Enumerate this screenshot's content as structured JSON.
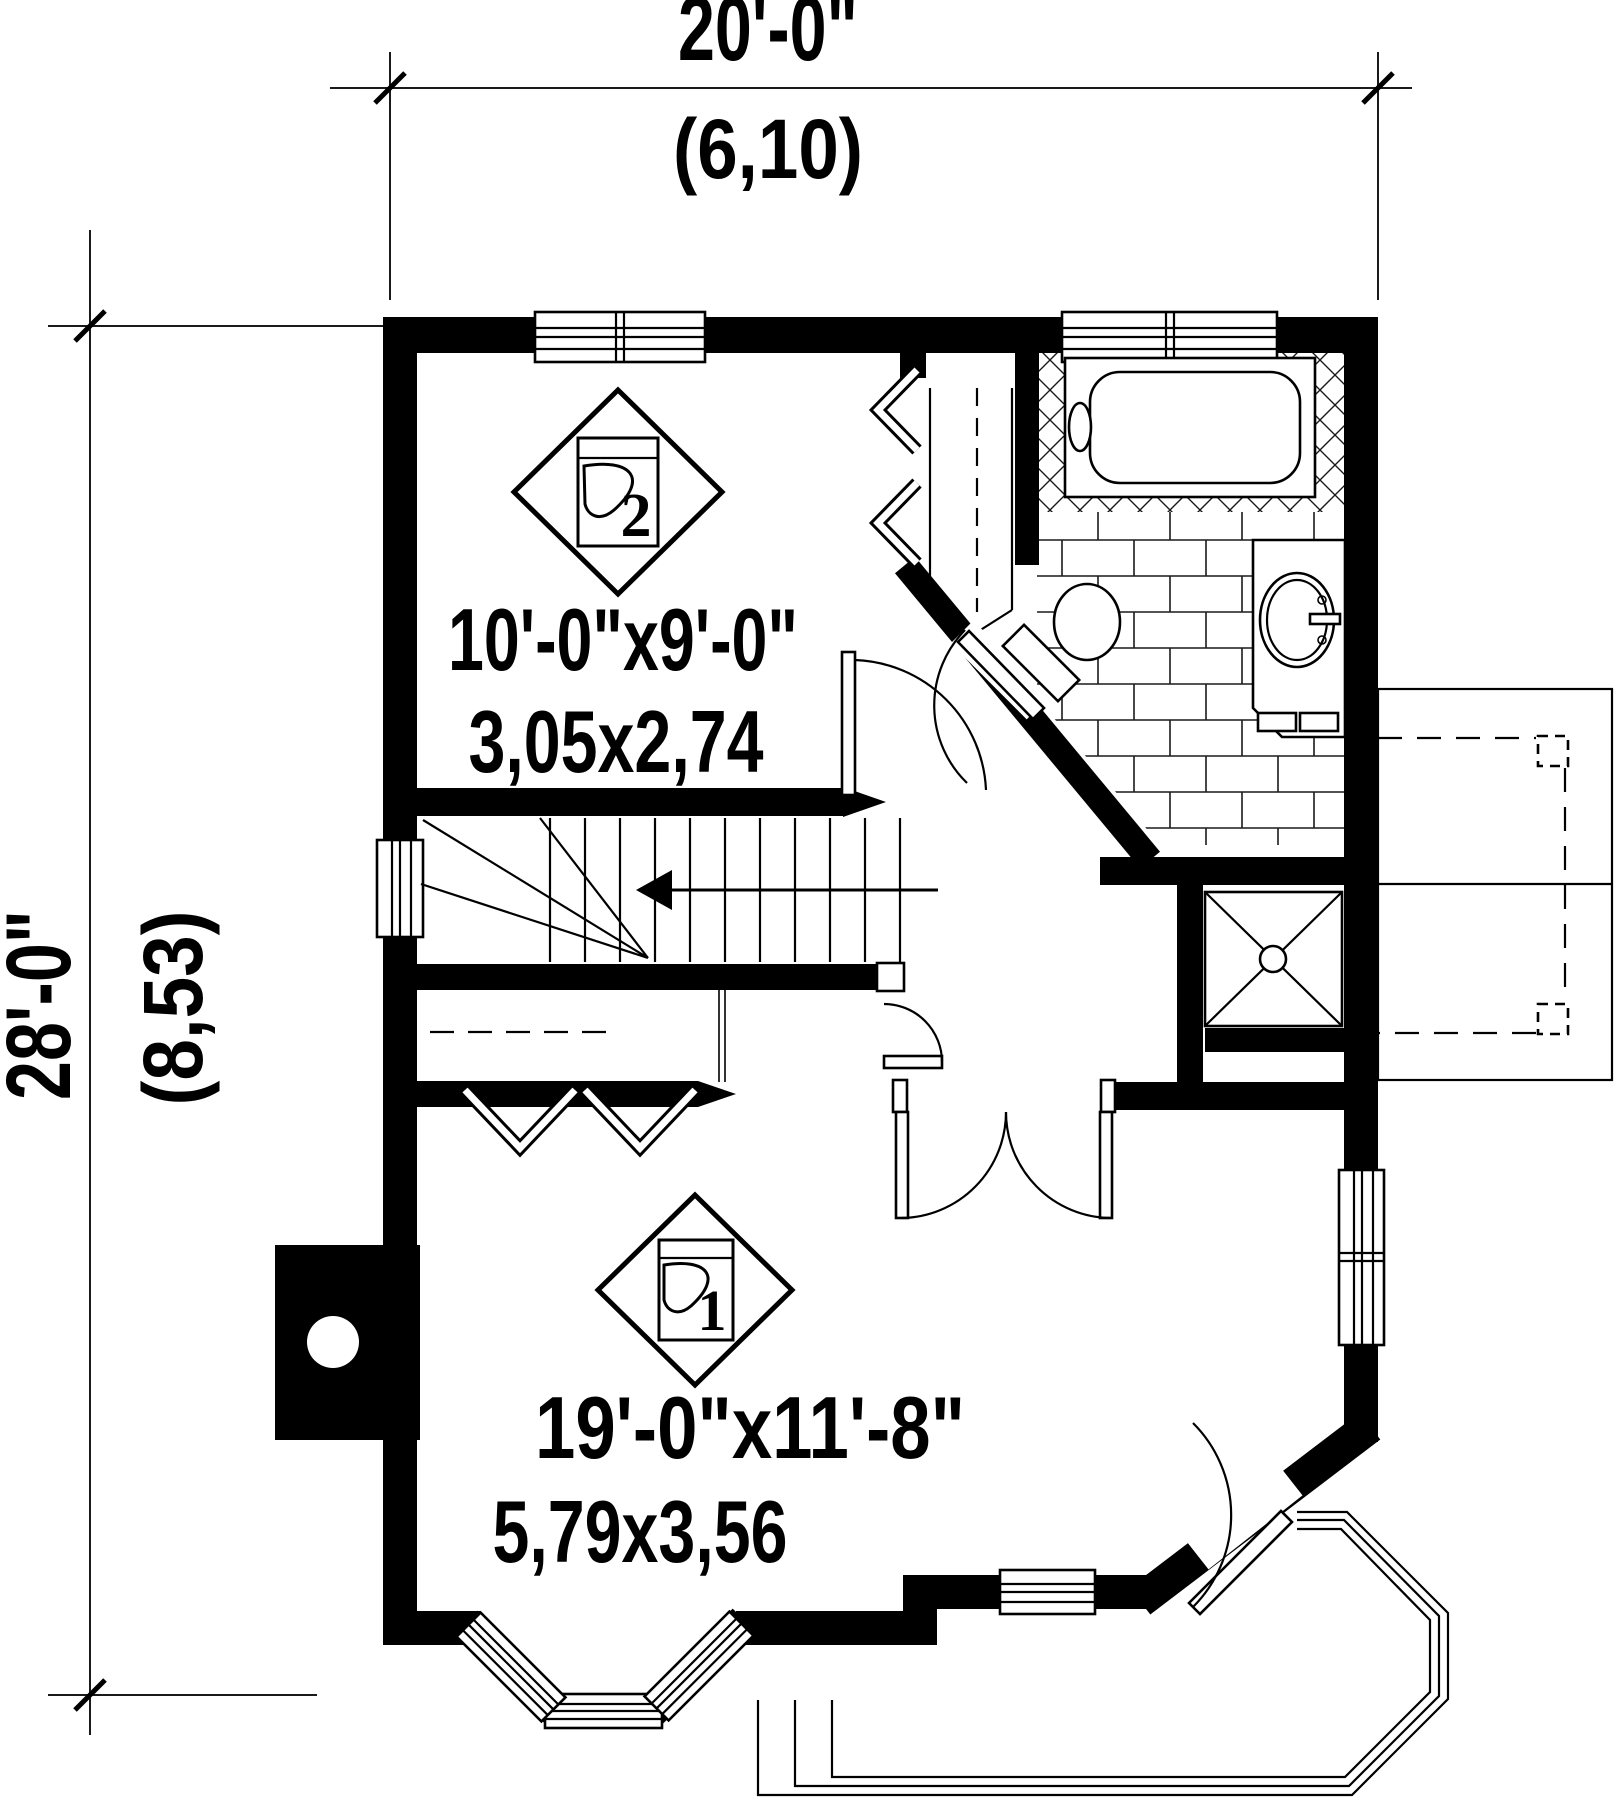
{
  "drawing": {
    "type": "floor-plan",
    "dimensions": {
      "top": {
        "imperial": "20'-0\"",
        "metric": "(6,10)"
      },
      "left": {
        "imperial": "28'-0\"",
        "metric": "(8,53)"
      }
    },
    "rooms": [
      {
        "stamp": "2",
        "imperial": "10'-0\"x9'-0\"",
        "metric": "3,05x2,74"
      },
      {
        "stamp": "1",
        "imperial": "19'-0\"x11'-8\"",
        "metric": "5,79x3,56"
      }
    ],
    "icons": {
      "floor_finish": "floor-finish-stamp"
    }
  }
}
